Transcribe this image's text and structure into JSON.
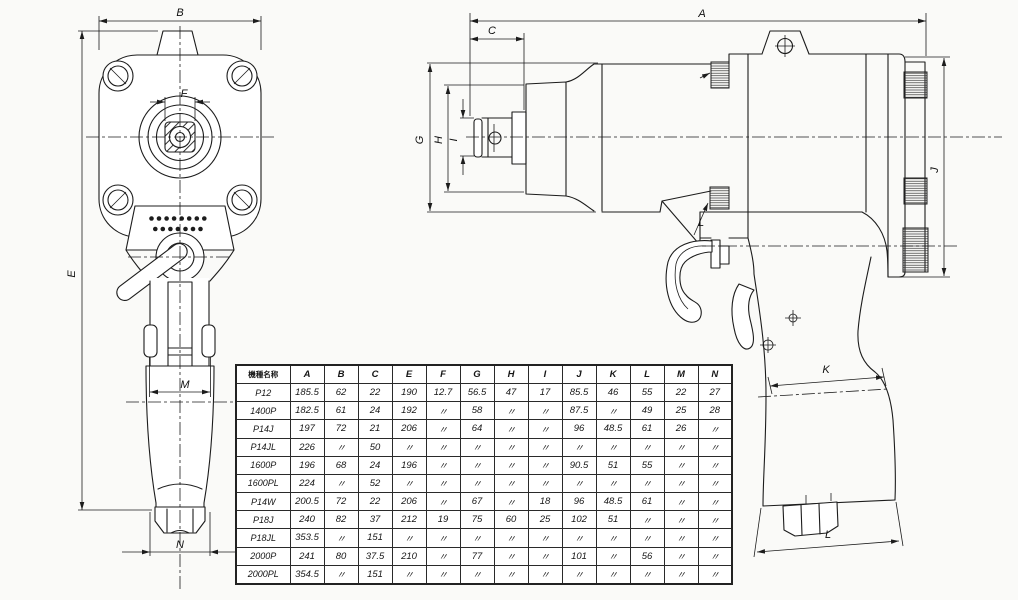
{
  "drawing": {
    "dims": {
      "A": "A",
      "B": "B",
      "C": "C",
      "E": "E",
      "F": "F",
      "G": "G",
      "H": "H",
      "I": "I",
      "J": "J",
      "K": "K",
      "L": "L",
      "L2": "L",
      "M": "M",
      "N": "N"
    }
  },
  "table": {
    "header": [
      "機種名称",
      "A",
      "B",
      "C",
      "E",
      "F",
      "G",
      "H",
      "I",
      "J",
      "K",
      "L",
      "M",
      "N"
    ],
    "rows": [
      [
        "P12",
        "185.5",
        "62",
        "22",
        "190",
        "12.7",
        "56.5",
        "47",
        "17",
        "85.5",
        "46",
        "55",
        "22",
        "27"
      ],
      [
        "1400P",
        "182.5",
        "61",
        "24",
        "192",
        "〃",
        "58",
        "〃",
        "〃",
        "87.5",
        "〃",
        "49",
        "25",
        "28"
      ],
      [
        "P14J",
        "197",
        "72",
        "21",
        "206",
        "〃",
        "64",
        "〃",
        "〃",
        "96",
        "48.5",
        "61",
        "26",
        "〃"
      ],
      [
        "P14JL",
        "226",
        "〃",
        "50",
        "〃",
        "〃",
        "〃",
        "〃",
        "〃",
        "〃",
        "〃",
        "〃",
        "〃",
        "〃"
      ],
      [
        "1600P",
        "196",
        "68",
        "24",
        "196",
        "〃",
        "〃",
        "〃",
        "〃",
        "90.5",
        "51",
        "55",
        "〃",
        "〃"
      ],
      [
        "1600PL",
        "224",
        "〃",
        "52",
        "〃",
        "〃",
        "〃",
        "〃",
        "〃",
        "〃",
        "〃",
        "〃",
        "〃",
        "〃"
      ],
      [
        "P14W",
        "200.5",
        "72",
        "22",
        "206",
        "〃",
        "67",
        "〃",
        "18",
        "96",
        "48.5",
        "61",
        "〃",
        "〃"
      ],
      [
        "P18J",
        "240",
        "82",
        "37",
        "212",
        "19",
        "75",
        "60",
        "25",
        "102",
        "51",
        "〃",
        "〃",
        "〃"
      ],
      [
        "P18JL",
        "353.5",
        "〃",
        "151",
        "〃",
        "〃",
        "〃",
        "〃",
        "〃",
        "〃",
        "〃",
        "〃",
        "〃",
        "〃"
      ],
      [
        "2000P",
        "241",
        "80",
        "37.5",
        "210",
        "〃",
        "77",
        "〃",
        "〃",
        "101",
        "〃",
        "56",
        "〃",
        "〃"
      ],
      [
        "2000PL",
        "354.5",
        "〃",
        "151",
        "〃",
        "〃",
        "〃",
        "〃",
        "〃",
        "〃",
        "〃",
        "〃",
        "〃",
        "〃"
      ]
    ]
  },
  "colors": {
    "line": "#1c1c1c",
    "paper": "#fafaf8"
  }
}
